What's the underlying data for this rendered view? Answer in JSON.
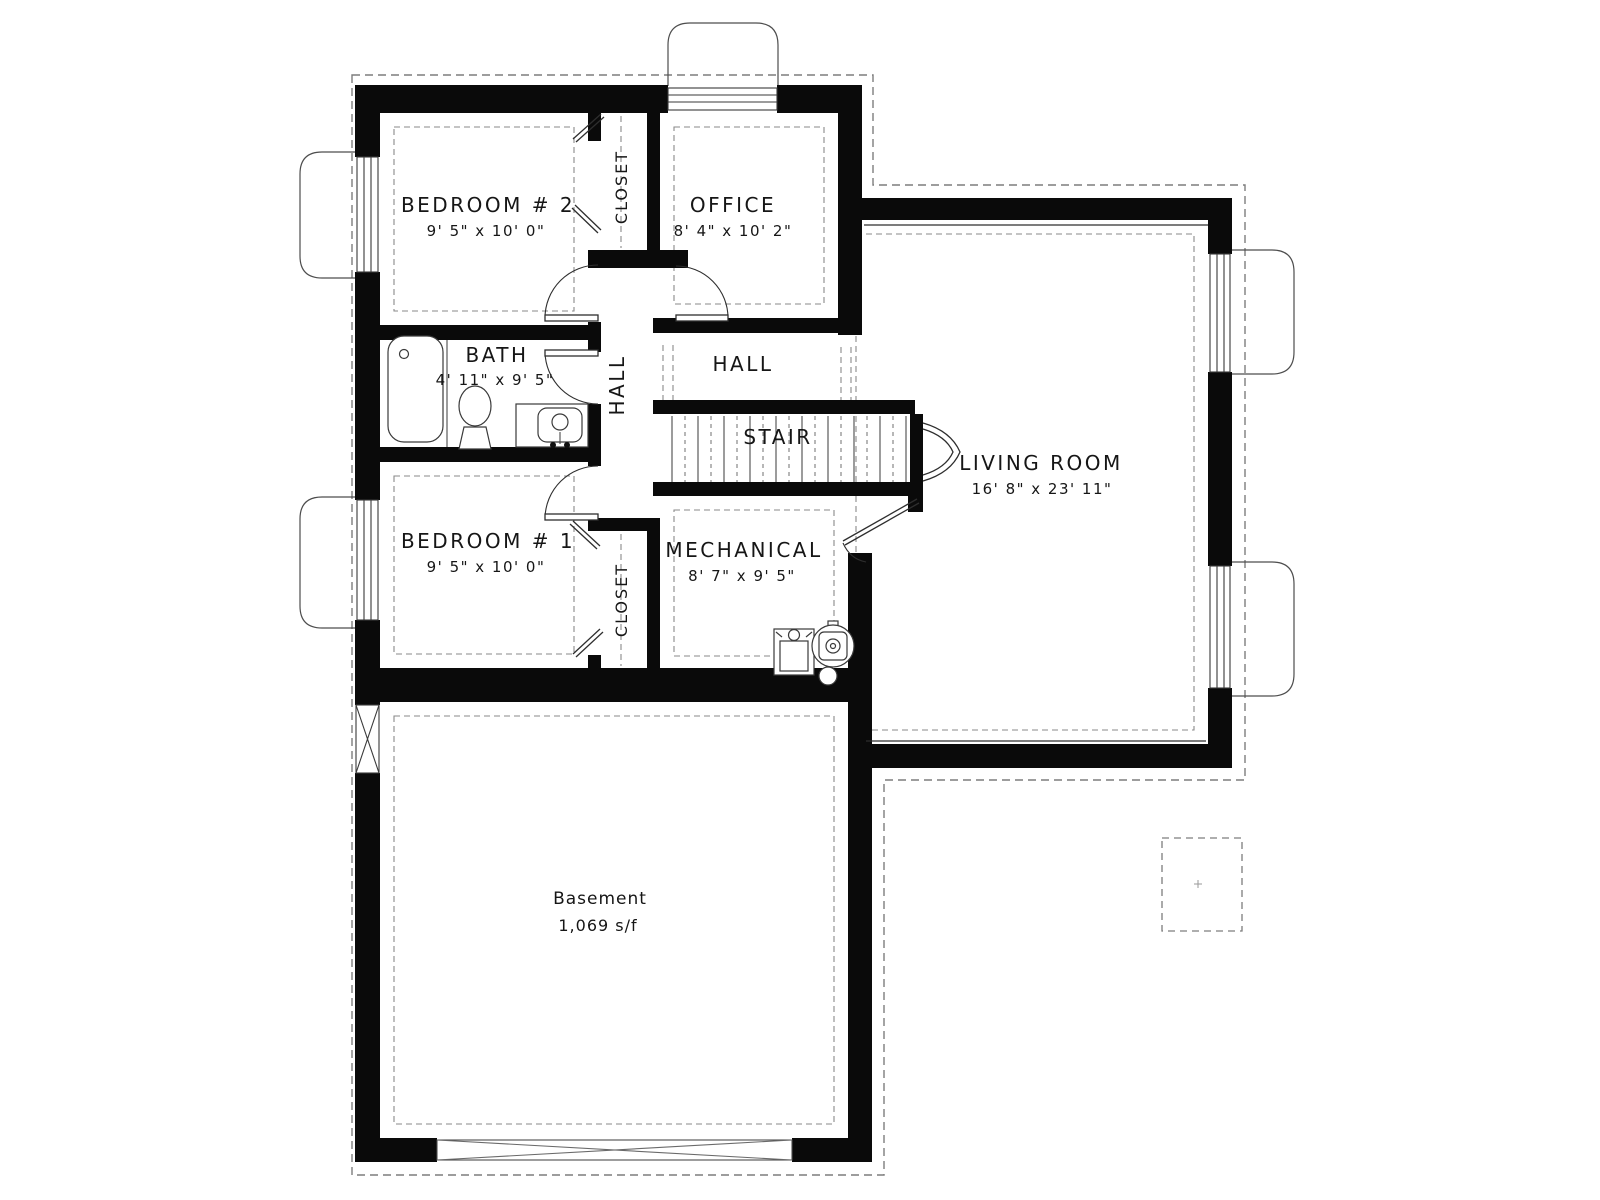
{
  "plan": {
    "type": "basement-floor-plan",
    "wall_color": "#0a0a0a",
    "line_color": "#3a3a3a",
    "dash_color": "#8a8a8a"
  },
  "rooms": {
    "bedroom2": {
      "name": "BEDROOM # 2",
      "dims": "9' 5\" x 10' 0\""
    },
    "office": {
      "name": "OFFICE",
      "dims": "8' 4\" x 10' 2\""
    },
    "closet_top": {
      "name": "CLOSET"
    },
    "bath": {
      "name": "BATH",
      "dims": "4' 11\" x 9' 5\""
    },
    "hall_vertical": {
      "name": "HALL"
    },
    "hall": {
      "name": "HALL"
    },
    "stair": {
      "name": "STAIR"
    },
    "living_room": {
      "name": "LIVING ROOM",
      "dims": "16' 8\" x 23' 11\""
    },
    "bedroom1": {
      "name": "BEDROOM # 1",
      "dims": "9' 5\" x 10' 0\""
    },
    "closet_bottom": {
      "name": "CLOSET"
    },
    "mechanical": {
      "name": "MECHANICAL",
      "dims": "8' 7\" x 9' 5\""
    },
    "basement": {
      "name": "Basement",
      "area": "1,069 s/f"
    }
  }
}
